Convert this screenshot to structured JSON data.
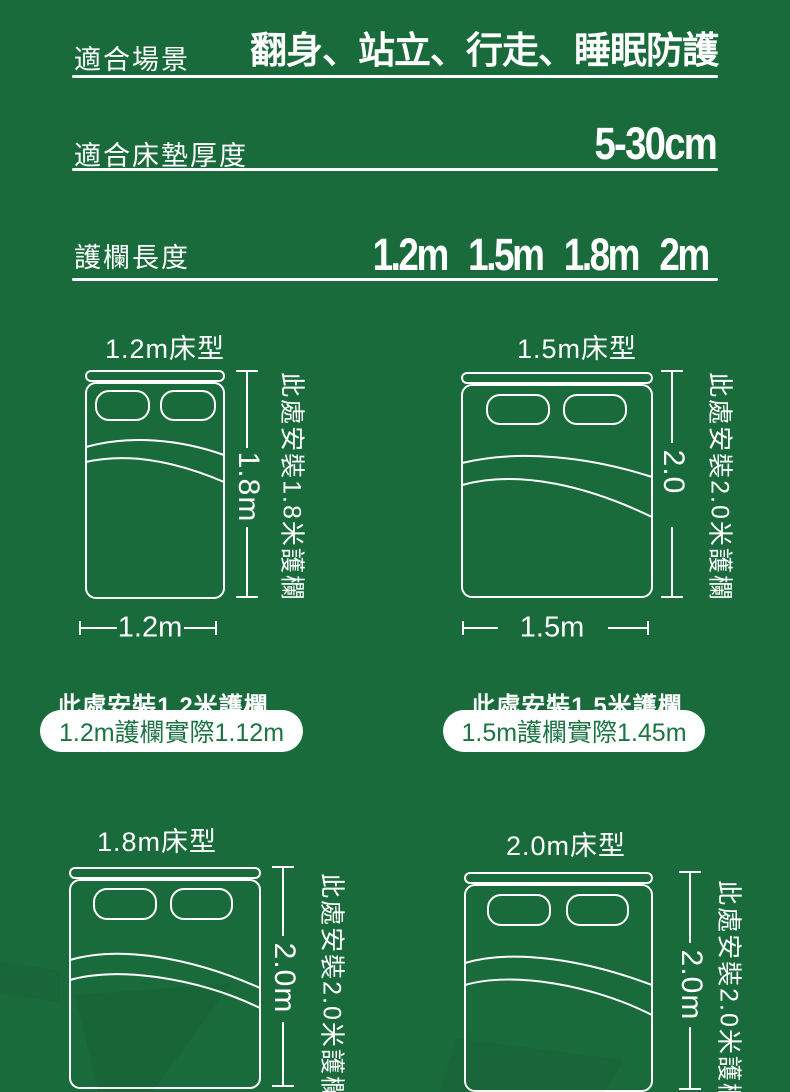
{
  "colors": {
    "background": "#1a6b3c",
    "foreground": "#ffffff",
    "pill_background": "#ffffff",
    "pill_text": "#1d7443"
  },
  "spec_rows": [
    {
      "label": "適合場景",
      "value": "翻身、站立、行走、睡眠防護"
    },
    {
      "label": "適合床墊厚度",
      "value": "5-30cm"
    },
    {
      "label": "護欄長度",
      "values": [
        "1.2m",
        "1.5m",
        "1.8m",
        "2m"
      ]
    }
  ],
  "beds": [
    {
      "title": "1.2m床型",
      "height_dim": "1.8m",
      "width_dim": "1.2m",
      "side_note": "此處安裝1.8米護欄",
      "bottom_note": "此處安裝1.2米護欄",
      "pill_text": "1.2m護欄實際1.12m"
    },
    {
      "title": "1.5m床型",
      "height_dim": "2.0",
      "width_dim": "1.5m",
      "side_note": "此處安裝2.0米護欄",
      "bottom_note": "此處安裝1.5米護欄",
      "pill_text": "1.5m護欄實際1.45m"
    },
    {
      "title": "1.8m床型",
      "height_dim": "2.0m",
      "side_note": "此處安裝2.0米護欄"
    },
    {
      "title": "2.0m床型",
      "height_dim": "2.0m",
      "side_note": "此處安裝2.0米護欄"
    }
  ]
}
